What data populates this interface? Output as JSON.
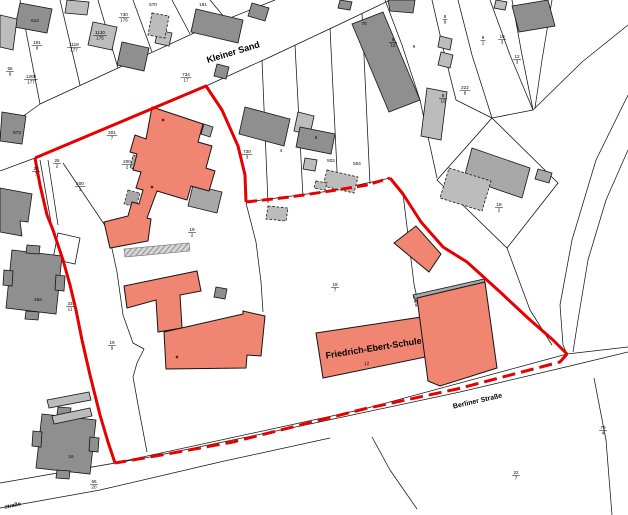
{
  "map": {
    "colors": {
      "boundary": "#e60000",
      "school": "#f08672",
      "bld-dark": "#8f8f8f",
      "bld-mid": "#a8a8a8",
      "bld-light": "#bcbcbc",
      "outline": "#141414",
      "school-text": "#7b1113",
      "background": "#ffffff"
    },
    "labels": [
      {
        "id": "street-kleiner-sand",
        "kind": "street",
        "text": "Kleiner Sand",
        "x": 234,
        "y": 55,
        "rot": -17,
        "size": 9,
        "bold": true
      },
      {
        "id": "street-berliner-strasse",
        "kind": "street",
        "text": "Berliner Straße",
        "x": 478,
        "y": 403,
        "rot": -13,
        "size": 7,
        "bold": true
      },
      {
        "id": "street-partial-strasse",
        "kind": "street",
        "text": "straße",
        "x": 13,
        "y": 507,
        "rot": -12,
        "size": 5.5,
        "bold": true
      },
      {
        "id": "school-name",
        "kind": "school",
        "text": "Friedrich-Ebert-Schule",
        "x": 374,
        "y": 351,
        "rot": -9,
        "size": 9,
        "bold": true,
        "color": "#7b1113"
      },
      {
        "id": "school-building-number",
        "kind": "school",
        "text": "12",
        "x": 367,
        "y": 365,
        "rot": -9,
        "size": 4.5,
        "color": "#7b1113"
      }
    ],
    "parcel_numbers": [
      {
        "n": "191",
        "d": "8",
        "x": 37,
        "y": 44
      },
      {
        "n": "1118",
        "d": "177",
        "x": 74,
        "y": 46
      },
      {
        "n": "1208",
        "d": "177",
        "x": 31,
        "y": 78
      },
      {
        "n": "55",
        "d": "9",
        "x": 10,
        "y": 70
      },
      {
        "n": "1120",
        "d": "175",
        "x": 100,
        "y": 34
      },
      {
        "n": "730",
        "d": "176",
        "x": 124,
        "y": 16
      },
      {
        "n": "734",
        "d": "17",
        "x": 186,
        "y": 76
      },
      {
        "n": "301",
        "d": "7",
        "x": 112,
        "y": 134
      },
      {
        "n": "200",
        "d": "2",
        "x": 127,
        "y": 163
      },
      {
        "n": "200",
        "d": "1",
        "x": 80,
        "y": 185
      },
      {
        "n": "25",
        "d": "2",
        "x": 57,
        "y": 162
      },
      {
        "n": "20",
        "d": "7",
        "x": 36,
        "y": 170
      },
      {
        "n": "33",
        "d": "11",
        "x": 70,
        "y": 305
      },
      {
        "n": "19",
        "d": "9",
        "x": 112,
        "y": 344
      },
      {
        "n": "19",
        "d": "2",
        "x": 192,
        "y": 231
      },
      {
        "n": "19",
        "d": "7",
        "x": 335,
        "y": 286
      },
      {
        "n": "730",
        "d": "3",
        "x": 247,
        "y": 153
      },
      {
        "n": "8",
        "d": "12",
        "x": 393,
        "y": 41
      },
      {
        "n": "8",
        "d": "9",
        "x": 445,
        "y": 18
      },
      {
        "n": "222",
        "d": "8",
        "x": 465,
        "y": 89
      },
      {
        "n": "8",
        "d": "10",
        "x": 443,
        "y": 97
      },
      {
        "n": "8",
        "d": "1",
        "x": 483,
        "y": 39
      },
      {
        "n": "10",
        "d": "3",
        "x": 502,
        "y": 38
      },
      {
        "n": "12",
        "d": "3",
        "x": 517,
        "y": 58
      },
      {
        "n": "18",
        "d": "2",
        "x": 499,
        "y": 206
      },
      {
        "n": "79",
        "d": "4",
        "x": 603,
        "y": 429
      },
      {
        "n": "22",
        "d": "7",
        "x": 516,
        "y": 474
      },
      {
        "n": "66",
        "d": "20",
        "x": 94,
        "y": 483
      }
    ],
    "parcel_singles": [
      {
        "text": "570",
        "x": 153,
        "y": 6
      },
      {
        "text": "181",
        "x": 203,
        "y": 6
      },
      {
        "text": "614",
        "x": 35,
        "y": 22
      },
      {
        "text": "973",
        "x": 17,
        "y": 134
      },
      {
        "text": "4",
        "x": 281,
        "y": 152
      },
      {
        "text": "502",
        "x": 331,
        "y": 162
      },
      {
        "text": "504",
        "x": 357,
        "y": 165
      },
      {
        "text": "9",
        "x": 414,
        "y": 48
      },
      {
        "text": "70",
        "x": 364,
        "y": 25
      },
      {
        "text": "6",
        "x": 316,
        "y": 139
      },
      {
        "text": "46a",
        "x": 38,
        "y": 301
      },
      {
        "text": "16",
        "x": 71,
        "y": 458
      }
    ],
    "house_marks": [
      {
        "x": 163,
        "y": 120
      },
      {
        "x": 152,
        "y": 187
      },
      {
        "x": 177,
        "y": 357
      }
    ]
  }
}
